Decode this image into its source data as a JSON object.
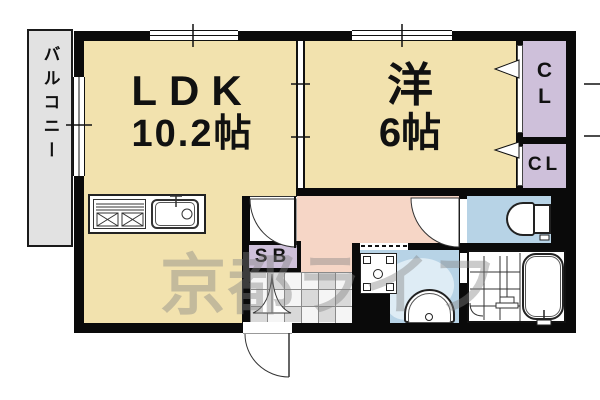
{
  "balcony": {
    "label": "バルコニー"
  },
  "ldk": {
    "label": "LDK",
    "size": "10.2帖"
  },
  "western_room": {
    "label": "洋",
    "size": "6帖"
  },
  "closets": {
    "top_line1": "C",
    "top_line2": "L",
    "bottom": "CL"
  },
  "shoe_box": {
    "label": "SB"
  },
  "watermark": {
    "text": "京都ライフ"
  },
  "colors": {
    "room": "#F2E2AE",
    "closet": "#CEC0DA",
    "hall": "#F6D6C6",
    "water": "#B7D3E6",
    "balcony": "#E2E2E2",
    "wall": "#0a0a0a"
  }
}
